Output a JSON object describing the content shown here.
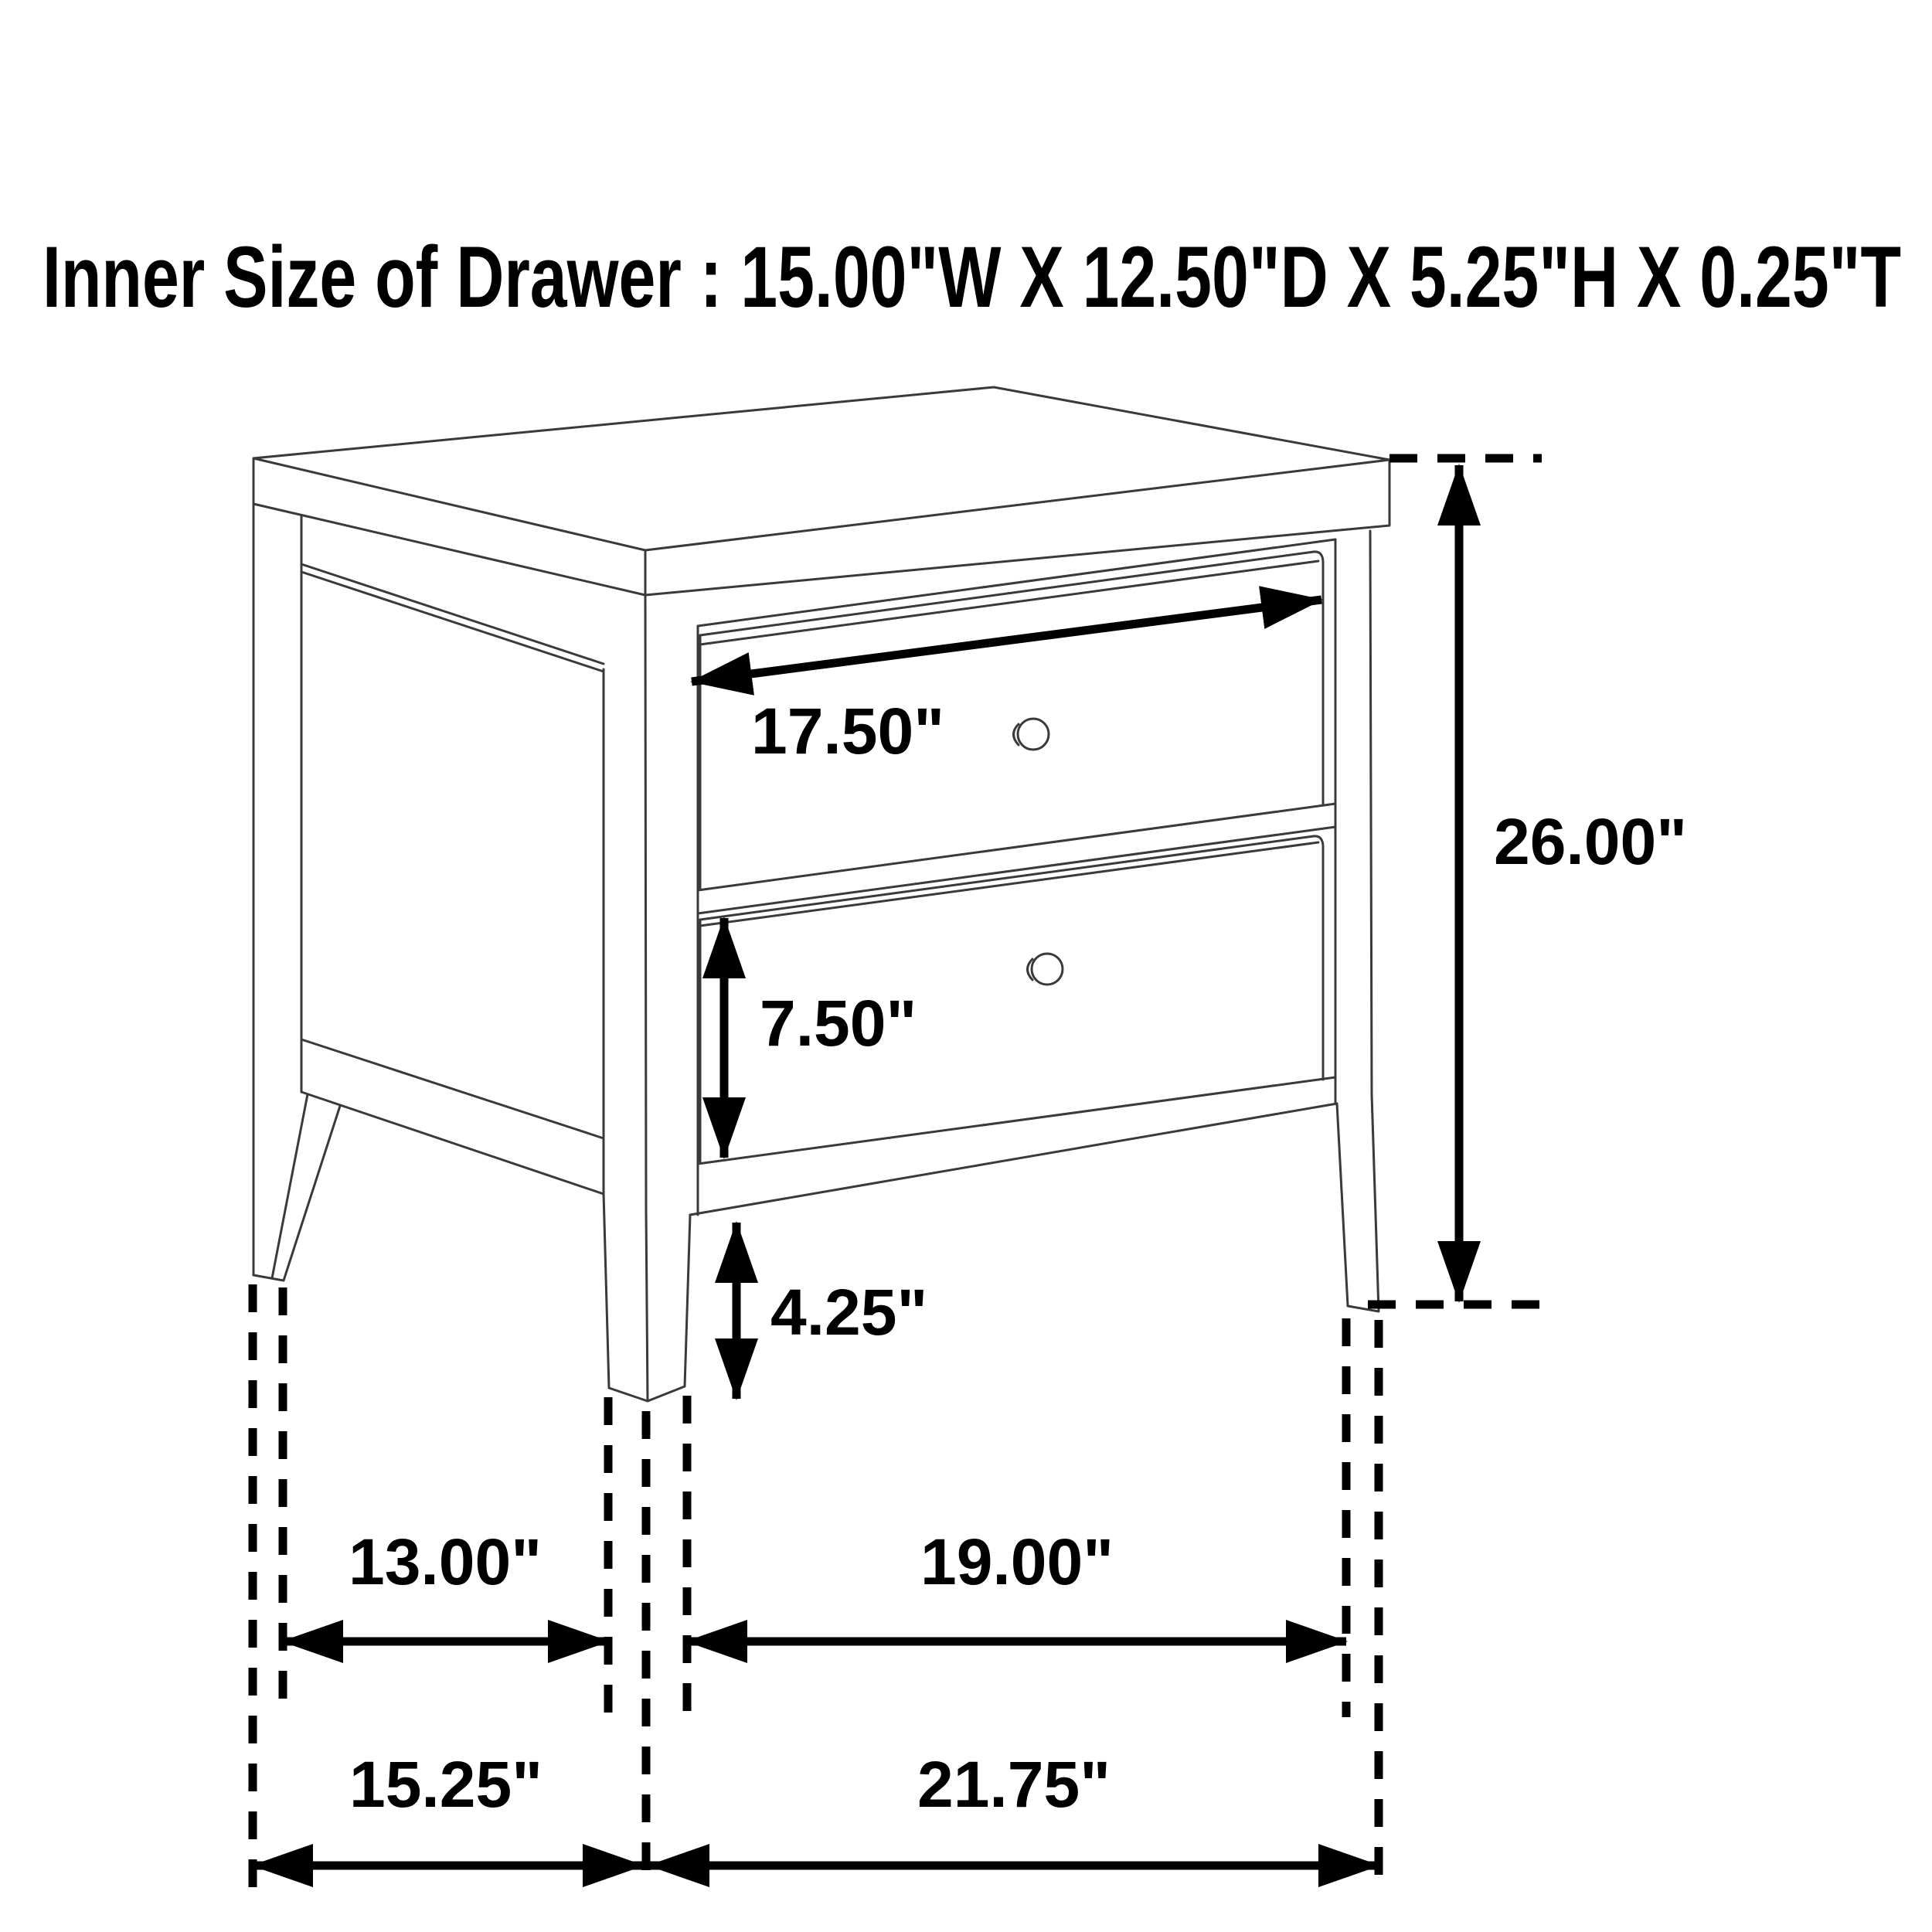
{
  "page": {
    "background": "#ffffff",
    "line_color": "#3a3a3a",
    "dimension_color": "#000000"
  },
  "title": "Inner Size of Drawer : 15.00\"W X 12.50\"D X 5.25\"H X 0.25\"T",
  "diagram": {
    "type": "furniture-dimension-drawing",
    "subject": "two-drawer nightstand line drawing with dimension arrows",
    "inner_drawer_size": {
      "width": "15.00\"W",
      "depth": "12.50\"D",
      "height": "5.25\"H",
      "thickness": "0.25\"T"
    },
    "labels": {
      "drawer_face_width": "17.50\"",
      "lower_drawer_height": "7.50\"",
      "leg_height": "4.25\"",
      "overall_height": "26.00\"",
      "side_inner_span": "13.00\"",
      "side_outer_span": "15.25\"",
      "front_inner_span": "19.00\"",
      "front_outer_span": "21.75\""
    }
  }
}
